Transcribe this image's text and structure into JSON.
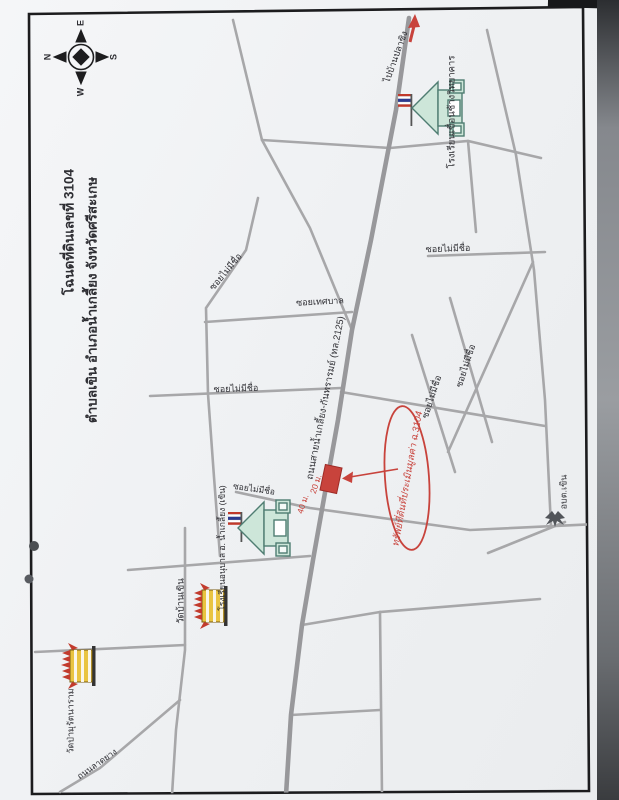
{
  "title": {
    "line1": "โฉนดที่ดินเลขที่ 3104",
    "line2": "ตำบลเขิน อำเภอน้ำเกลี้ยง จังหวัดศรีสะเกษ"
  },
  "compass": {
    "e": "E",
    "n": "N",
    "s": "S",
    "w": "W"
  },
  "road_labels": {
    "to_destination": "ไปบ้านปลาซิง",
    "main_road": "ถนนสายน้ำเกลี้ยง-กันทรารมย์ (ทล.2125)",
    "soi_unnamed": "ซอยไม่มีชื่อ",
    "soi_thetsaban": "ซอยเทศบาล",
    "paved_road": "ถนนลาดยาง"
  },
  "places": {
    "school_north": "โรงเรียนเขื่อนช้างวิทยาคาร",
    "school_south": "โรงเรียนอนุบาล อ. น้ำเกลี้ยง (เขิน)",
    "temple_khoen": "วัดบ้านเขิน",
    "temple_pa": "วัดป่ามุรัตนาราม",
    "sao_office": "อบต.เขิน"
  },
  "property": {
    "callout": "ทรัพย์ที่ดินที่ประเมินมูลค่า ฉ.3104",
    "width_label": "20 ม.",
    "depth_label": "40 ม."
  },
  "colors": {
    "highlight_red": "#c8433c",
    "road_gray": "#a7a7a9",
    "main_road_gray": "#98989b",
    "school_fill": "#cde6d9",
    "temple_gold": "#e9c441",
    "frame_black": "#1c1c1e"
  }
}
